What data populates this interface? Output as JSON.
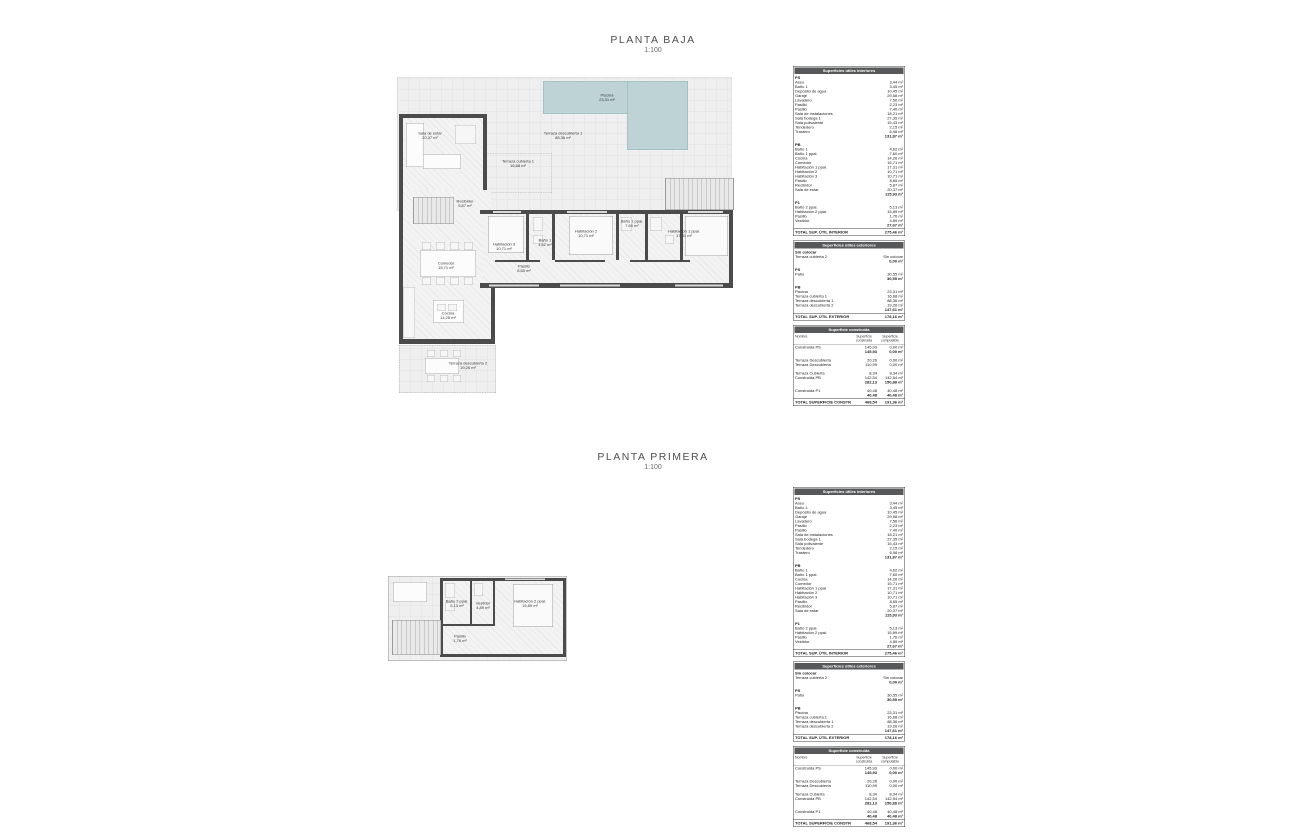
{
  "sheets": {
    "planta_baja": {
      "title": "PLANTA BAJA",
      "scale": "1:100"
    },
    "planta_primera": {
      "title": "PLANTA PRIMERA",
      "scale": "1:100"
    }
  },
  "colors": {
    "pool_fill": "#bdd3d6",
    "wall": "#4b4b4b",
    "table_header_bg": "#57585a"
  },
  "plan_baja": {
    "rooms": {
      "piscina": {
        "name": "Piscina",
        "area": "23,31 m²"
      },
      "terraza_descubierta_1": {
        "name": "Terraza descubierta 1",
        "area": "88,36 m²"
      },
      "terraza_cubierta_1": {
        "name": "Terraza cubierta 1",
        "area": "16,68 m²"
      },
      "sala_estar": {
        "name": "Sala de estar",
        "area": "20,37 m²"
      },
      "recibidor": {
        "name": "Recibidor",
        "area": "5,87 m²"
      },
      "comedor": {
        "name": "Comedor",
        "area": "15,71 m²"
      },
      "cocina": {
        "name": "Cocina",
        "area": "14,26 m²"
      },
      "terraza_descubierta_2": {
        "name": "Terraza descubierta 2",
        "area": "19,26 m²"
      },
      "pasillo": {
        "name": "Pasillo",
        "area": "8,65 m²"
      },
      "habitacion_3": {
        "name": "Habitación 3",
        "area": "10,71 m²"
      },
      "bano_1": {
        "name": "Baño 1",
        "area": "4,62 m²"
      },
      "habitacion_2": {
        "name": "Habitación 2",
        "area": "10,71 m²"
      },
      "bano_1_ppal": {
        "name": "Baño 1 ppal.",
        "area": "7,60 m²"
      },
      "habitacion_1_ppal": {
        "name": "Habitación 1 ppal.",
        "area": "17,31 m²"
      }
    }
  },
  "plan_primera": {
    "rooms": {
      "bano_2_ppal": {
        "name": "Baño 2 ppal.",
        "area": "5,13 m²"
      },
      "vestidor": {
        "name": "Vestidor",
        "area": "4,89 m²"
      },
      "habitacion_2_ppal": {
        "name": "Habitación 2 ppal.",
        "area": "15,89 m²"
      },
      "pasillo": {
        "name": "Pasillo",
        "area": "1,76 m²"
      }
    }
  },
  "tables": {
    "interior": {
      "title": "Superficies útiles interiores",
      "sections": [
        {
          "label": "PS",
          "rows": [
            [
              "Aseo",
              "3,44 m²"
            ],
            [
              "Baño 1",
              "3,45 m²"
            ],
            [
              "Depósito de agua",
              "10,45 m²"
            ],
            [
              "Garaje",
              "29,58 m²"
            ],
            [
              "Lavadero",
              "7,56 m²"
            ],
            [
              "Pasillo",
              "2,23 m²"
            ],
            [
              "Pasillo",
              "7,40 m²"
            ],
            [
              "Sala de instalaciones",
              "18,21 m²"
            ],
            [
              "Sala bodega 1",
              "27,35 m²"
            ],
            [
              "Sala polivalente",
              "15,43 m²"
            ],
            [
              "Tendedero",
              "2,15 m²"
            ],
            [
              "Trastero",
              "6,98 m²"
            ]
          ],
          "subtotal": "131,87 m²"
        },
        {
          "label": "PB",
          "rows": [
            [
              "Baño 1",
              "4,62 m²"
            ],
            [
              "Baño 1 ppal.",
              "7,60 m²"
            ],
            [
              "Cocina",
              "14,26 m²"
            ],
            [
              "Comedor",
              "15,71 m²"
            ],
            [
              "Habitación 1 ppal.",
              "17,31 m²"
            ],
            [
              "Habitación 2",
              "10,71 m²"
            ],
            [
              "Habitación 3",
              "10,71 m²"
            ],
            [
              "Pasillo",
              "8,65 m²"
            ],
            [
              "Recibidor",
              "5,87 m²"
            ],
            [
              "Sala de estar",
              "20,37 m²"
            ]
          ],
          "subtotal": "115,93 m²"
        },
        {
          "label": "P1",
          "rows": [
            [
              "Baño 2 ppal.",
              "5,13 m²"
            ],
            [
              "Habitación 2 ppal.",
              "15,89 m²"
            ],
            [
              "Pasillo",
              "1,76 m²"
            ],
            [
              "Vestidor",
              "4,89 m²"
            ]
          ],
          "subtotal": "27,67 m²"
        }
      ],
      "total_label": "TOTAL SUP. ÚTIL INTERIOR",
      "total_value": "275,46 m²"
    },
    "exterior": {
      "title": "Superficies útiles exteriores",
      "sections": [
        {
          "label": "Sin colocar",
          "rows": [
            [
              "Terraza cubierta 2",
              "Sin colocar"
            ]
          ],
          "subtotal": "0,00 m²"
        },
        {
          "label": "PS",
          "rows": [
            [
              "Patio",
              "30,55 m²"
            ]
          ],
          "subtotal": "30,55 m²"
        },
        {
          "label": "PB",
          "rows": [
            [
              "Piscina",
              "23,31 m²"
            ],
            [
              "Terraza cubierta 1",
              "16,68 m²"
            ],
            [
              "Terraza descubierta 1",
              "88,36 m²"
            ],
            [
              "Terraza descubierta 2",
              "19,26 m²"
            ]
          ],
          "subtotal": "147,61 m²"
        }
      ],
      "total_label": "TOTAL SUP. ÚTIL EXTERIOR",
      "total_value": "178,16 m²"
    },
    "construida": {
      "title": "Superficie construida",
      "col_headers": [
        "Nombre",
        "Superficie construida",
        "Superficie computable"
      ],
      "groups": [
        {
          "rows": [
            [
              "Construida PS",
              "145,93",
              "0,00 m²"
            ]
          ],
          "subtotal": [
            "145,93",
            "0,00 m²"
          ]
        },
        {
          "rows": [
            [
              "Terraza Descubierta",
              "20,26",
              "0,00 m²"
            ],
            [
              "Terraza Descubierta",
              "110,99",
              "0,00 m²"
            ]
          ],
          "subtotal": null
        },
        {
          "rows": [
            [
              "Terraza Cubierta",
              "8,34",
              "8,34 m²"
            ],
            [
              "Construida PB",
              "142,54",
              "142,54 m²"
            ]
          ],
          "subtotal": [
            "282,13",
            "150,88 m²"
          ]
        },
        {
          "rows": [
            [
              "Construida P1",
              "40,48",
              "40,48 m²"
            ]
          ],
          "subtotal": [
            "40,48",
            "40,48 m²"
          ]
        }
      ],
      "total_label": "TOTAL SUPERFICIE CONSTRUIDA:",
      "total_values": [
        "468,54",
        "191,36 m²"
      ]
    }
  }
}
